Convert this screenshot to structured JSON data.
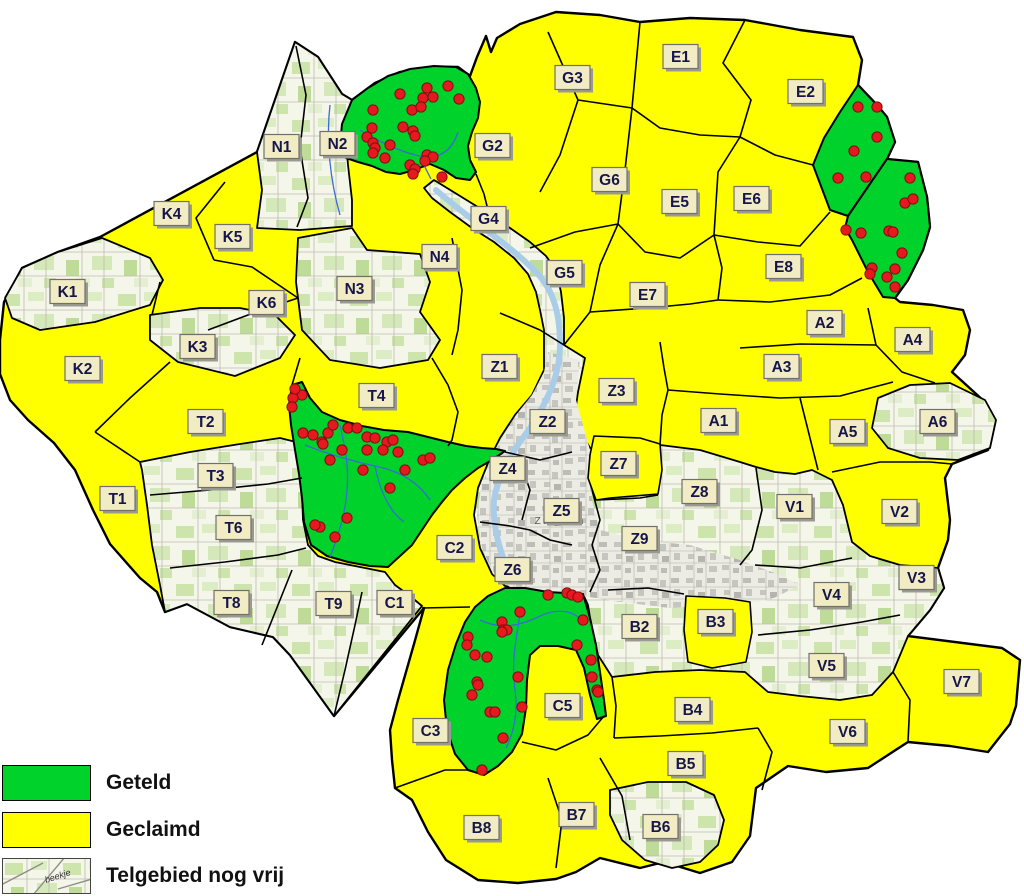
{
  "legend": {
    "items": [
      {
        "id": "geteld",
        "label": "Geteld",
        "swatch": "green"
      },
      {
        "id": "geclaimd",
        "label": "Geclaimd",
        "swatch": "yellow"
      },
      {
        "id": "vrij",
        "label": "Telgebied nog vrij",
        "swatch": "topo"
      }
    ],
    "topo_swatch_text": "beekje"
  },
  "city_label": "Zutphen",
  "colors": {
    "counted": "#00d22c",
    "claimed": "#ffff00",
    "border": "#000000",
    "dot": "#e6191f",
    "dot_border": "#7d1013",
    "label_bg": "#f2ecc4",
    "label_border": "#71716b",
    "label_text": "#16164a",
    "label_shadow": "#9a9a92",
    "stream": "#3a6bd6",
    "river": "#a9cde9",
    "city_text": "#555555"
  },
  "regions": [
    {
      "id": "N1",
      "label": "N1",
      "x": 282,
      "y": 147,
      "status": "vrij"
    },
    {
      "id": "N2",
      "label": "N2",
      "x": 338,
      "y": 144,
      "status": "vrij"
    },
    {
      "id": "N3",
      "label": "N3",
      "x": 355,
      "y": 289,
      "status": "vrij"
    },
    {
      "id": "N4",
      "label": "N4",
      "x": 440,
      "y": 257,
      "status": "geclaimd"
    },
    {
      "id": "G2",
      "label": "G2",
      "x": 493,
      "y": 146,
      "status": "geclaimd"
    },
    {
      "id": "G3",
      "label": "G3",
      "x": 573,
      "y": 78,
      "status": "geclaimd"
    },
    {
      "id": "G4",
      "label": "G4",
      "x": 489,
      "y": 219,
      "status": "vrij"
    },
    {
      "id": "G5",
      "label": "G5",
      "x": 565,
      "y": 273,
      "status": "geclaimd"
    },
    {
      "id": "G6",
      "label": "G6",
      "x": 610,
      "y": 180,
      "status": "geclaimd"
    },
    {
      "id": "E1",
      "label": "E1",
      "x": 681,
      "y": 57,
      "status": "geclaimd"
    },
    {
      "id": "E2",
      "label": "E2",
      "x": 806,
      "y": 92,
      "status": "geclaimd"
    },
    {
      "id": "E5",
      "label": "E5",
      "x": 680,
      "y": 202,
      "status": "geclaimd"
    },
    {
      "id": "E6",
      "label": "E6",
      "x": 752,
      "y": 199,
      "status": "geclaimd"
    },
    {
      "id": "E7",
      "label": "E7",
      "x": 648,
      "y": 295,
      "status": "geclaimd"
    },
    {
      "id": "E8",
      "label": "E8",
      "x": 784,
      "y": 267,
      "status": "geclaimd"
    },
    {
      "id": "K1",
      "label": "K1",
      "x": 68,
      "y": 292,
      "status": "vrij"
    },
    {
      "id": "K2",
      "label": "K2",
      "x": 83,
      "y": 369,
      "status": "geclaimd"
    },
    {
      "id": "K3",
      "label": "K3",
      "x": 198,
      "y": 347,
      "status": "vrij"
    },
    {
      "id": "K4",
      "label": "K4",
      "x": 172,
      "y": 214,
      "status": "geclaimd"
    },
    {
      "id": "K5",
      "label": "K5",
      "x": 233,
      "y": 237,
      "status": "geclaimd"
    },
    {
      "id": "K6",
      "label": "K6",
      "x": 267,
      "y": 303,
      "status": "geclaimd"
    },
    {
      "id": "T1",
      "label": "T1",
      "x": 118,
      "y": 499,
      "status": "geclaimd"
    },
    {
      "id": "T2",
      "label": "T2",
      "x": 206,
      "y": 422,
      "status": "geclaimd"
    },
    {
      "id": "T3",
      "label": "T3",
      "x": 216,
      "y": 476,
      "status": "vrij"
    },
    {
      "id": "T4",
      "label": "T4",
      "x": 377,
      "y": 396,
      "status": "geclaimd"
    },
    {
      "id": "T6",
      "label": "T6",
      "x": 234,
      "y": 528,
      "status": "vrij"
    },
    {
      "id": "T8",
      "label": "T8",
      "x": 232,
      "y": 603,
      "status": "vrij"
    },
    {
      "id": "T9",
      "label": "T9",
      "x": 334,
      "y": 604,
      "status": "vrij"
    },
    {
      "id": "Z1",
      "label": "Z1",
      "x": 500,
      "y": 367,
      "status": "geclaimd"
    },
    {
      "id": "Z2",
      "label": "Z2",
      "x": 548,
      "y": 422,
      "status": "vrij"
    },
    {
      "id": "Z3",
      "label": "Z3",
      "x": 617,
      "y": 391,
      "status": "geclaimd"
    },
    {
      "id": "Z4",
      "label": "Z4",
      "x": 508,
      "y": 469,
      "status": "vrij"
    },
    {
      "id": "Z5",
      "label": "Z5",
      "x": 562,
      "y": 511,
      "status": "vrij"
    },
    {
      "id": "Z6",
      "label": "Z6",
      "x": 513,
      "y": 570,
      "status": "vrij"
    },
    {
      "id": "Z7",
      "label": "Z7",
      "x": 619,
      "y": 464,
      "status": "geclaimd"
    },
    {
      "id": "Z8",
      "label": "Z8",
      "x": 700,
      "y": 492,
      "status": "vrij"
    },
    {
      "id": "Z9",
      "label": "Z9",
      "x": 640,
      "y": 539,
      "status": "vrij"
    },
    {
      "id": "A1",
      "label": "A1",
      "x": 719,
      "y": 421,
      "status": "geclaimd"
    },
    {
      "id": "A2",
      "label": "A2",
      "x": 825,
      "y": 323,
      "status": "geclaimd"
    },
    {
      "id": "A3",
      "label": "A3",
      "x": 782,
      "y": 367,
      "status": "geclaimd"
    },
    {
      "id": "A4",
      "label": "A4",
      "x": 913,
      "y": 340,
      "status": "geclaimd"
    },
    {
      "id": "A5",
      "label": "A5",
      "x": 848,
      "y": 432,
      "status": "geclaimd"
    },
    {
      "id": "A6",
      "label": "A6",
      "x": 938,
      "y": 422,
      "status": "vrij"
    },
    {
      "id": "C1",
      "label": "C1",
      "x": 395,
      "y": 603,
      "status": "vrij"
    },
    {
      "id": "C2",
      "label": "C2",
      "x": 455,
      "y": 548,
      "status": "geclaimd"
    },
    {
      "id": "C3",
      "label": "C3",
      "x": 431,
      "y": 731,
      "status": "geclaimd"
    },
    {
      "id": "C5",
      "label": "C5",
      "x": 563,
      "y": 706,
      "status": "geclaimd"
    },
    {
      "id": "V1",
      "label": "V1",
      "x": 795,
      "y": 507,
      "status": "vrij"
    },
    {
      "id": "V2",
      "label": "V2",
      "x": 900,
      "y": 512,
      "status": "geclaimd"
    },
    {
      "id": "V3",
      "label": "V3",
      "x": 917,
      "y": 578,
      "status": "vrij"
    },
    {
      "id": "V4",
      "label": "V4",
      "x": 832,
      "y": 595,
      "status": "vrij"
    },
    {
      "id": "V5",
      "label": "V5",
      "x": 827,
      "y": 666,
      "status": "vrij"
    },
    {
      "id": "V6",
      "label": "V6",
      "x": 848,
      "y": 732,
      "status": "geclaimd"
    },
    {
      "id": "V7",
      "label": "V7",
      "x": 962,
      "y": 682,
      "status": "geclaimd"
    },
    {
      "id": "B2",
      "label": "B2",
      "x": 640,
      "y": 627,
      "status": "vrij"
    },
    {
      "id": "B3",
      "label": "B3",
      "x": 716,
      "y": 622,
      "status": "geclaimd"
    },
    {
      "id": "B4",
      "label": "B4",
      "x": 693,
      "y": 710,
      "status": "geclaimd"
    },
    {
      "id": "B5",
      "label": "B5",
      "x": 686,
      "y": 764,
      "status": "geclaimd"
    },
    {
      "id": "B6",
      "label": "B6",
      "x": 661,
      "y": 827,
      "status": "vrij"
    },
    {
      "id": "B7",
      "label": "B7",
      "x": 577,
      "y": 815,
      "status": "geclaimd"
    },
    {
      "id": "B8",
      "label": "B8",
      "x": 482,
      "y": 828,
      "status": "geclaimd"
    }
  ],
  "geometry": {
    "silhouette": "100,237 257,152 295,42 318,57 342,94 352,100 375,83 400,72 430,67 458,67 470,76 477,57 486,36 491,52 497,38 520,24 556,12 600,15 640,22 690,18 745,20 800,30 853,37 862,60 858,85 877,105 887,117 895,142 887,159 918,162 927,197 930,227 923,250 908,280 895,298 900,302 933,305 963,310 970,330 965,355 952,372 985,402 995,420 988,450 952,464 945,478 950,520 948,540 938,568 944,588 930,610 908,636 1002,648 1020,660 1016,706 1010,724 988,752 950,746 908,742 868,768 826,772 788,766 756,788 750,836 732,862 700,873 664,862 640,868 600,858 576,872 556,879 518,883 478,880 446,860 428,832 412,800 395,788 392,760 390,730 398,700 406,672 414,644 424,608 334,716 290,655 273,637 230,627 187,604 165,612 157,592 140,578 110,544 93,510 75,470 54,443 28,420 10,400 0,374 0,340 4,302 22,268 58,252",
    "topo_areas": [
      {
        "name": "n1-n2",
        "points": "257,152 295,42 318,57 342,94 352,100 345,128 348,165 352,200 352,226 300,230 257,228 262,190"
      },
      {
        "name": "k1",
        "points": "5,298 22,268 58,252 102,238 150,258 163,280 150,305 95,322 40,330 12,318"
      },
      {
        "name": "k3",
        "points": "150,315 200,308 240,308 275,315 295,335 280,358 235,376 178,362 150,340"
      },
      {
        "name": "n3",
        "points": "298,238 352,228 367,250 420,254 430,282 420,312 440,340 428,360 380,368 330,360 302,330 296,282"
      },
      {
        "name": "t3-t6-t8-t9-c1",
        "points": "140,462 190,452 240,444 280,438 296,442 298,458 302,490 303,520 308,545 318,556 335,562 355,566 375,570 385,572 395,585 410,596 422,606 334,716 290,655 273,637 230,627 187,604 165,612 160,585 152,545 147,505 142,470"
      },
      {
        "name": "east-zutphen",
        "points": "434,180 460,196 486,212 510,228 530,242 546,256 556,270 561,292 564,318 564,345 585,358 578,392 574,420 590,448 640,442 660,445 700,450 740,462 756,467 775,472 795,474 812,470 832,480 843,505 852,542 870,556 900,565 938,568 944,588 930,610 908,636 893,672 872,695 840,700 800,696 768,692 745,672 700,670 655,672 612,677 598,655 592,630 588,605 583,594 560,592 530,590 505,586 492,574 480,548 474,515 478,488 490,458 500,438 515,415 532,395 544,370 544,330 540,310 536,292 528,274 514,258 494,242 472,228 450,212 432,198 424,188"
      },
      {
        "name": "a6",
        "points": "878,398 910,385 950,383 985,400 996,420 990,448 958,460 920,458 888,448 872,428"
      },
      {
        "name": "b6",
        "points": "610,790 648,782 686,782 714,795 724,820 718,845 700,862 672,868 645,860 622,840 610,815"
      }
    ],
    "urban": "548,352 580,360 576,400 590,450 592,500 600,530 640,540 690,545 740,560 780,575 800,585 770,600 720,605 670,608 620,602 583,596 545,592 510,587 493,574 482,548 477,515 481,488 492,458 502,438 516,415 532,395 544,372",
    "river": "M436,190 C470,220 510,245 536,272 C556,292 560,320 560,345 C560,375 548,400 530,428 C512,452 498,475 494,500 C492,525 500,555 512,578",
    "yellow_patches": [
      {
        "name": "z7",
        "points": "594,436 640,438 660,444 662,470 658,494 610,498 596,500 588,478 590,455"
      },
      {
        "name": "b3",
        "points": "686,596 725,598 750,602 752,632 746,662 712,668 688,662 684,630"
      }
    ],
    "green_areas": [
      {
        "name": "geteld-noord",
        "points": "352,100 368,88 388,76 410,69 434,66 456,67 468,74 476,88 480,102 478,118 472,132 468,146 470,160 476,172 470,180 456,178 444,170 430,164 414,170 400,174 386,172 372,166 358,162 346,158 340,146 342,124"
      },
      {
        "name": "geteld-noordoost-1",
        "points": "858,85 877,105 887,117 895,142 887,159 848,216 830,210 813,165 824,138 840,112"
      },
      {
        "name": "geteld-noordoost-2",
        "points": "887,159 918,162 927,197 930,227 923,250 908,280 895,298 883,297 868,272 852,240 845,228 848,216"
      },
      {
        "name": "geteld-centraal",
        "points": "292,385 302,382 310,398 322,412 340,420 362,426 384,430 408,432 428,437 448,442 466,446 482,448 496,449 505,451 492,460 478,468 465,478 452,490 442,502 432,515 422,530 412,545 400,556 388,567 370,566 348,562 327,556 311,545 304,522 302,498 299,474 295,450 291,425 289,405"
      },
      {
        "name": "geteld-zuid",
        "points": "475,607 488,596 505,588 525,588 548,592 565,593 583,594 590,618 596,645 600,672 604,700 606,716 597,719 590,695 584,668 576,650 558,646 540,646 530,655 527,680 526,708 522,734 512,752 498,766 484,775 468,770 455,754 447,730 444,700 448,670 456,644 465,622"
      }
    ],
    "streams": [
      "M330,105 C326,140 330,180 340,215",
      "M360,130 C380,142 400,152 420,156 C440,160 452,150 458,132",
      "M420,156 C424,166 428,173 431,179",
      "M305,445 C330,455 352,461 375,466 C400,471 418,482 430,500",
      "M340,425 C346,452 350,472 346,500 C343,522 336,542 330,557",
      "M375,466 C380,492 390,512 404,522",
      "M480,620 C500,630 520,626 540,616 C558,608 572,611 582,620",
      "M520,614 C516,640 511,662 515,690 C518,712 514,732 506,748"
    ],
    "border_lines": [
      "296,46 306,95 300,148 308,198 297,227",
      "548,32 578,100",
      "640,22 632,108",
      "578,100 632,108",
      "578,100 560,155 540,192",
      "530,248 575,232 618,224",
      "632,108 625,170 618,224",
      "745,20 723,63 751,100 740,137",
      "632,108 660,128 700,135 740,137",
      "740,137 775,155 813,165",
      "740,137 718,172 714,235",
      "618,224 645,252 680,258 714,235",
      "714,235 758,242 800,246 830,212",
      "714,235 722,268 718,300",
      "618,224 600,265 590,312",
      "590,312 648,308 690,304 718,300",
      "718,300 770,302 830,295 862,278",
      "500,313 540,330 564,345",
      "564,345 590,312",
      "452,238 462,290 458,330 452,355",
      "432,358 448,385 458,412 452,440 448,446",
      "225,182 196,218 214,260",
      "214,260 252,267 298,298",
      "208,330 256,312 298,298",
      "170,362 130,398 95,432",
      "95,432 140,462",
      "300,358 292,385",
      "868,308 876,345",
      "740,348 800,344 876,345",
      "876,345 902,372 935,383",
      "660,342 664,368 668,390",
      "668,390 720,394 780,398",
      "780,398 840,396 893,382",
      "800,398 810,438 818,470",
      "660,445 662,415 668,390",
      "832,472 880,462 930,462 952,464",
      "422,608 470,607",
      "395,788 445,770 468,770",
      "548,778 562,820 556,868",
      "522,742 556,750 588,735 604,716",
      "614,738 660,736 712,733 758,728",
      "612,677 616,706 614,738",
      "600,758 622,796 630,840",
      "758,728 772,752 762,790",
      "893,672 910,700 908,742",
      "150,495 210,490 268,484 302,478",
      "170,568 225,562 278,555 306,548",
      "262,645 278,605 292,570",
      "334,716 345,670 355,625 362,592",
      "505,452 540,460 572,452",
      "520,462 530,490 522,520",
      "480,522 510,526 530,530",
      "530,530 550,540 572,545",
      "592,490 600,520 592,545",
      "592,545 600,570 590,592",
      "597,500 640,498 658,495",
      "756,468 762,510 752,550 740,565",
      "755,565 800,568 852,558",
      "758,635 810,630 862,622 900,615",
      "608,590 648,588 684,594",
      "160,282 152,315",
      "476,174 484,194 488,210"
    ],
    "dots": {
      "noord": [
        [
          448,
          86
        ],
        [
          427,
          88
        ],
        [
          423,
          98
        ],
        [
          433,
          97
        ],
        [
          400,
          94
        ],
        [
          373,
          110
        ],
        [
          412,
          110
        ],
        [
          421,
          107
        ],
        [
          403,
          127
        ],
        [
          413,
          131
        ],
        [
          415,
          136
        ],
        [
          372,
          128
        ],
        [
          367,
          137
        ],
        [
          373,
          143
        ],
        [
          375,
          148
        ],
        [
          373,
          153
        ],
        [
          385,
          158
        ],
        [
          390,
          145
        ],
        [
          427,
          155
        ],
        [
          433,
          157
        ],
        [
          410,
          165
        ],
        [
          415,
          169
        ],
        [
          413,
          174
        ],
        [
          442,
          177
        ],
        [
          425,
          161
        ],
        [
          459,
          99
        ]
      ],
      "noordoost": [
        [
          858,
          107
        ],
        [
          877,
          107
        ],
        [
          877,
          137
        ],
        [
          854,
          151
        ],
        [
          838,
          178
        ],
        [
          866,
          177
        ],
        [
          910,
          178
        ],
        [
          905,
          203
        ],
        [
          913,
          199
        ],
        [
          846,
          230
        ],
        [
          861,
          233
        ],
        [
          889,
          231
        ],
        [
          893,
          232
        ],
        [
          902,
          253
        ],
        [
          872,
          268
        ],
        [
          870,
          274
        ],
        [
          895,
          269
        ],
        [
          887,
          277
        ],
        [
          895,
          287
        ]
      ],
      "centraal": [
        [
          302,
          395
        ],
        [
          293,
          398
        ],
        [
          292,
          407
        ],
        [
          295,
          389
        ],
        [
          303,
          433
        ],
        [
          313,
          435
        ],
        [
          322,
          442
        ],
        [
          323,
          444
        ],
        [
          328,
          433
        ],
        [
          333,
          425
        ],
        [
          342,
          450
        ],
        [
          348,
          428
        ],
        [
          357,
          428
        ],
        [
          367,
          437
        ],
        [
          375,
          438
        ],
        [
          387,
          442
        ],
        [
          393,
          440
        ],
        [
          383,
          450
        ],
        [
          398,
          452
        ],
        [
          367,
          450
        ],
        [
          330,
          460
        ],
        [
          363,
          470
        ],
        [
          405,
          470
        ],
        [
          423,
          460
        ],
        [
          430,
          458
        ],
        [
          390,
          488
        ],
        [
          347,
          518
        ],
        [
          320,
          527
        ],
        [
          335,
          537
        ],
        [
          315,
          525
        ]
      ],
      "zuid": [
        [
          548,
          595
        ],
        [
          567,
          593
        ],
        [
          572,
          595
        ],
        [
          578,
          597
        ],
        [
          520,
          612
        ],
        [
          502,
          622
        ],
        [
          503,
          630
        ],
        [
          507,
          630
        ],
        [
          502,
          632
        ],
        [
          583,
          620
        ],
        [
          577,
          645
        ],
        [
          591,
          660
        ],
        [
          592,
          677
        ],
        [
          597,
          690
        ],
        [
          598,
          692
        ],
        [
          468,
          637
        ],
        [
          467,
          645
        ],
        [
          475,
          655
        ],
        [
          487,
          657
        ],
        [
          477,
          682
        ],
        [
          478,
          685
        ],
        [
          472,
          695
        ],
        [
          518,
          677
        ],
        [
          522,
          707
        ],
        [
          490,
          712
        ],
        [
          495,
          712
        ],
        [
          503,
          738
        ],
        [
          482,
          770
        ]
      ]
    },
    "city_label_pos": [
      560,
      524
    ]
  }
}
